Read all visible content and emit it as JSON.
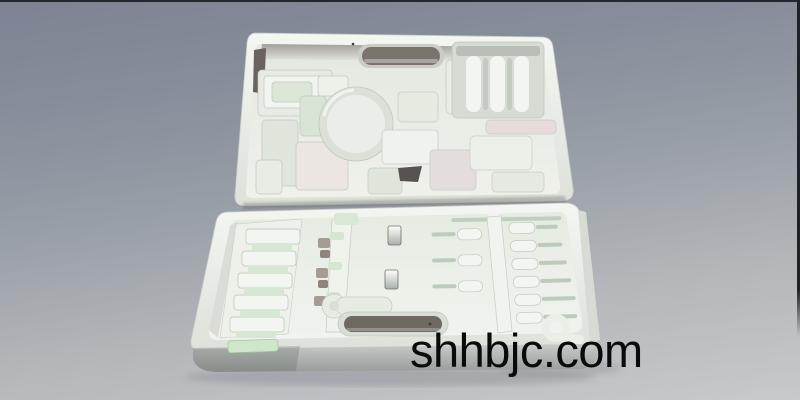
{
  "watermark": {
    "text": "shhbjc.com",
    "color": "#0a0a0a"
  },
  "scene": {
    "subject": "Open blow-molded plastic tool case with custom molded tool inserts, lid tilted back",
    "colors": {
      "background_top": "#7d8392",
      "background_bottom": "#c7c9ca",
      "frame_line": "#23262c",
      "case_body": "#eef0ea",
      "case_rim_shadow": "#c3c7c0",
      "insert_green": "#d4e6d0",
      "insert_pink": "#e9dfdc",
      "deep_slot_dark": "#6e6a62",
      "handle_slot_dark": "#7b746c",
      "tray_front_gray": "#9b9f9d",
      "metal_clip": "#f4f6f2",
      "shadow": "#6f747c"
    }
  }
}
